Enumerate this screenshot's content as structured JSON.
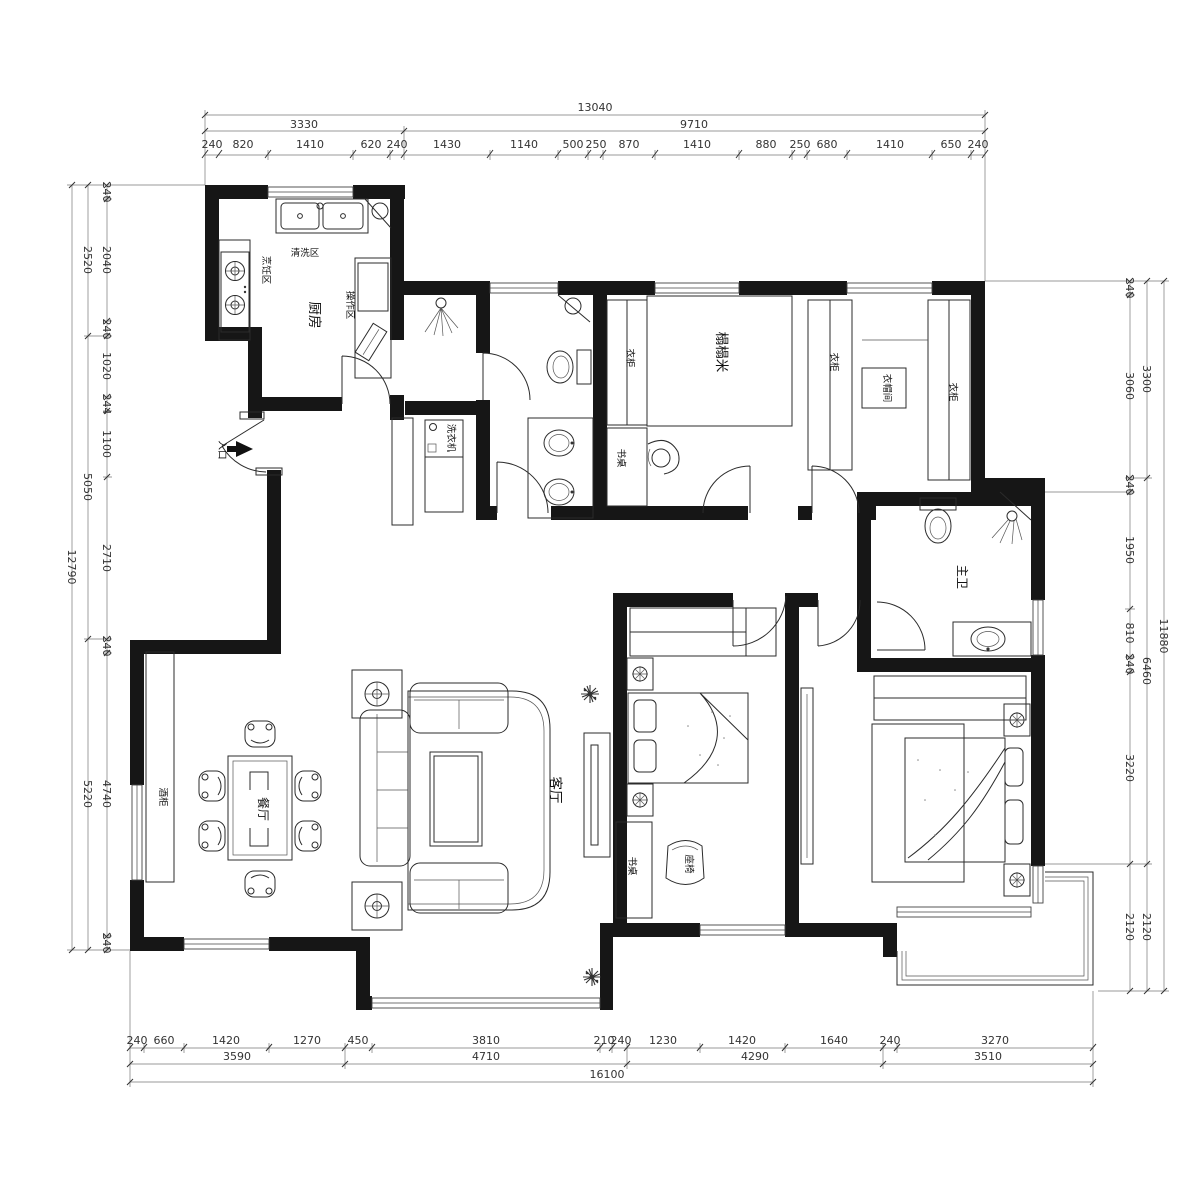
{
  "dimensions": {
    "top": {
      "total": "13040",
      "subtotals": [
        "3330",
        "9710"
      ],
      "details": [
        "240",
        "820",
        "1410",
        "620",
        "240",
        "1430",
        "1140",
        "500",
        "250",
        "870",
        "1410",
        "880",
        "250",
        "680",
        "1410",
        "650",
        "240"
      ]
    },
    "bottom": {
      "total": "16100",
      "subtotals": [
        "3590",
        "4710",
        "4290",
        "3510"
      ],
      "details": [
        "240",
        "660",
        "1420",
        "1270",
        "450",
        "3810",
        "210",
        "240",
        "1230",
        "1420",
        "1640",
        "240",
        "3270"
      ]
    },
    "left": {
      "total": "12790",
      "subtotals": [
        "2520",
        "5050",
        "5220"
      ],
      "details": [
        "240",
        "2040",
        "240",
        "1020",
        "244",
        "1100",
        "2710",
        "240",
        "4740",
        "240"
      ]
    },
    "right": {
      "total": "11880",
      "subtotals": [
        "3300",
        "6460",
        "2120"
      ],
      "details": [
        "240",
        "3060",
        "240",
        "1950",
        "810",
        "240",
        "3220",
        "2120"
      ]
    }
  },
  "rooms": {
    "kitchen": "厨房",
    "wash_zone": "清洗区",
    "cook_zone": "烹饪区",
    "prep_zone": "操作区",
    "washer": "洗衣机",
    "tatami": "榻榻米",
    "wardrobe": "衣柜",
    "closet": "衣帽间",
    "desk": "书桌",
    "master_bath": "主卫",
    "living": "客厅",
    "dining": "餐厅",
    "wine_cabinet": "酒柜",
    "chair": "座椅",
    "entrance": "入口"
  },
  "colors": {
    "wall": "#161616",
    "line": "#2b2b2b",
    "dim_text": "#333333",
    "background": "#ffffff"
  }
}
